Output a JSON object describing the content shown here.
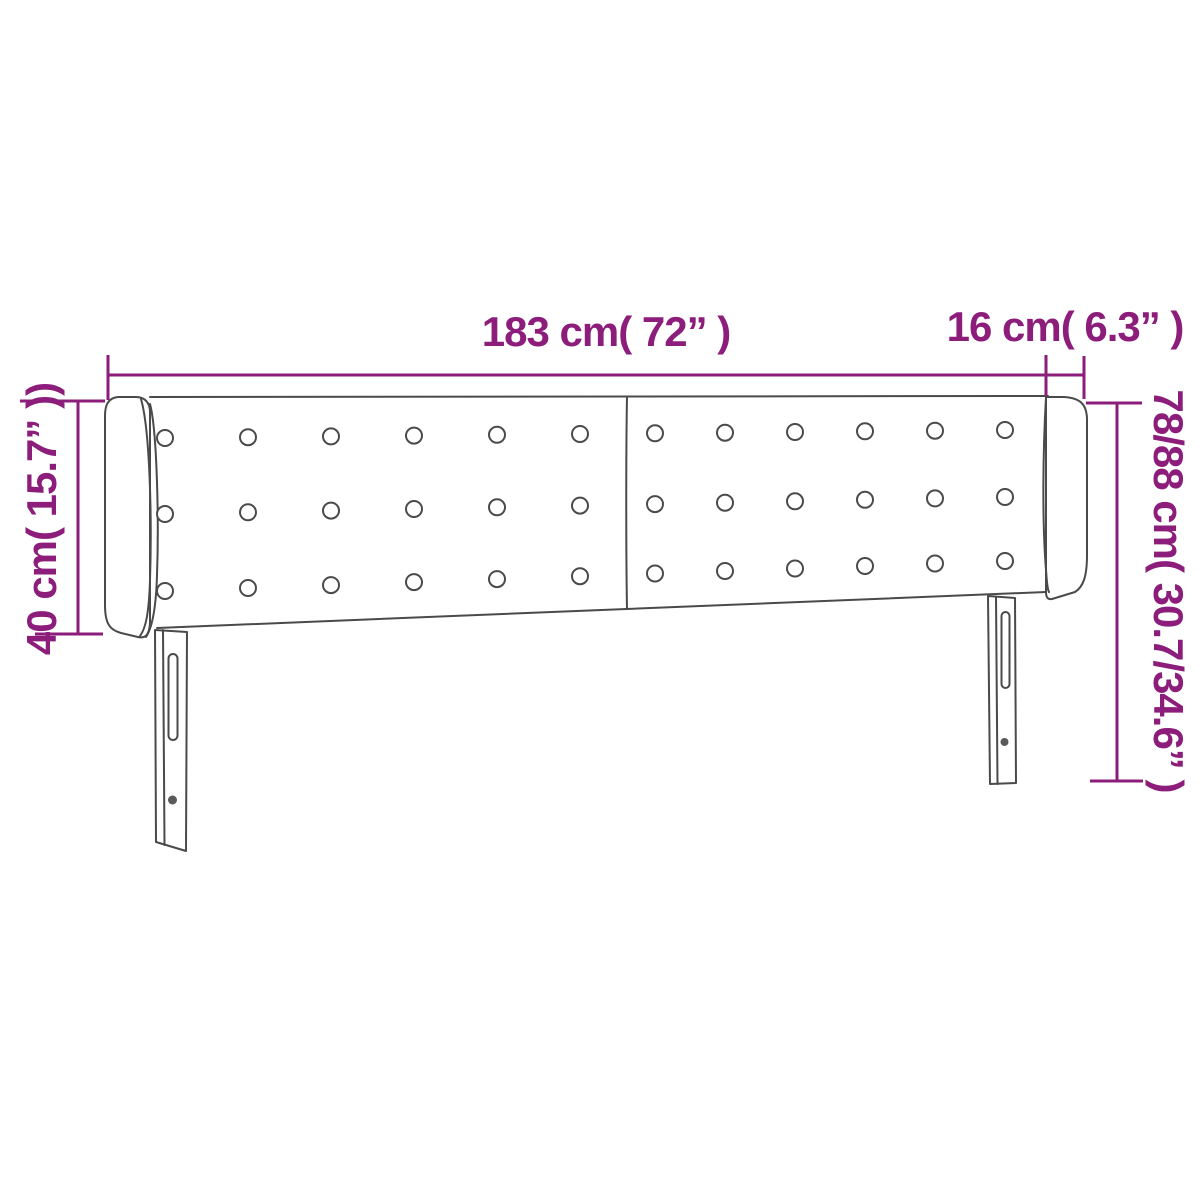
{
  "colors": {
    "accent_purple": "#8C1D7B",
    "outline_gray": "#4A4A4A",
    "background": "#FFFFFF"
  },
  "dimension_labels": {
    "front_width": "183 cm( 72” )",
    "side_depth": "16 cm( 6.3” )",
    "wing_height": "40 cm( 15.7” ))",
    "total_height": "78/88 cm( 30.7/34.6” )"
  },
  "tufting": {
    "rows": 3,
    "columns_per_panel": 6,
    "panels": 2
  }
}
